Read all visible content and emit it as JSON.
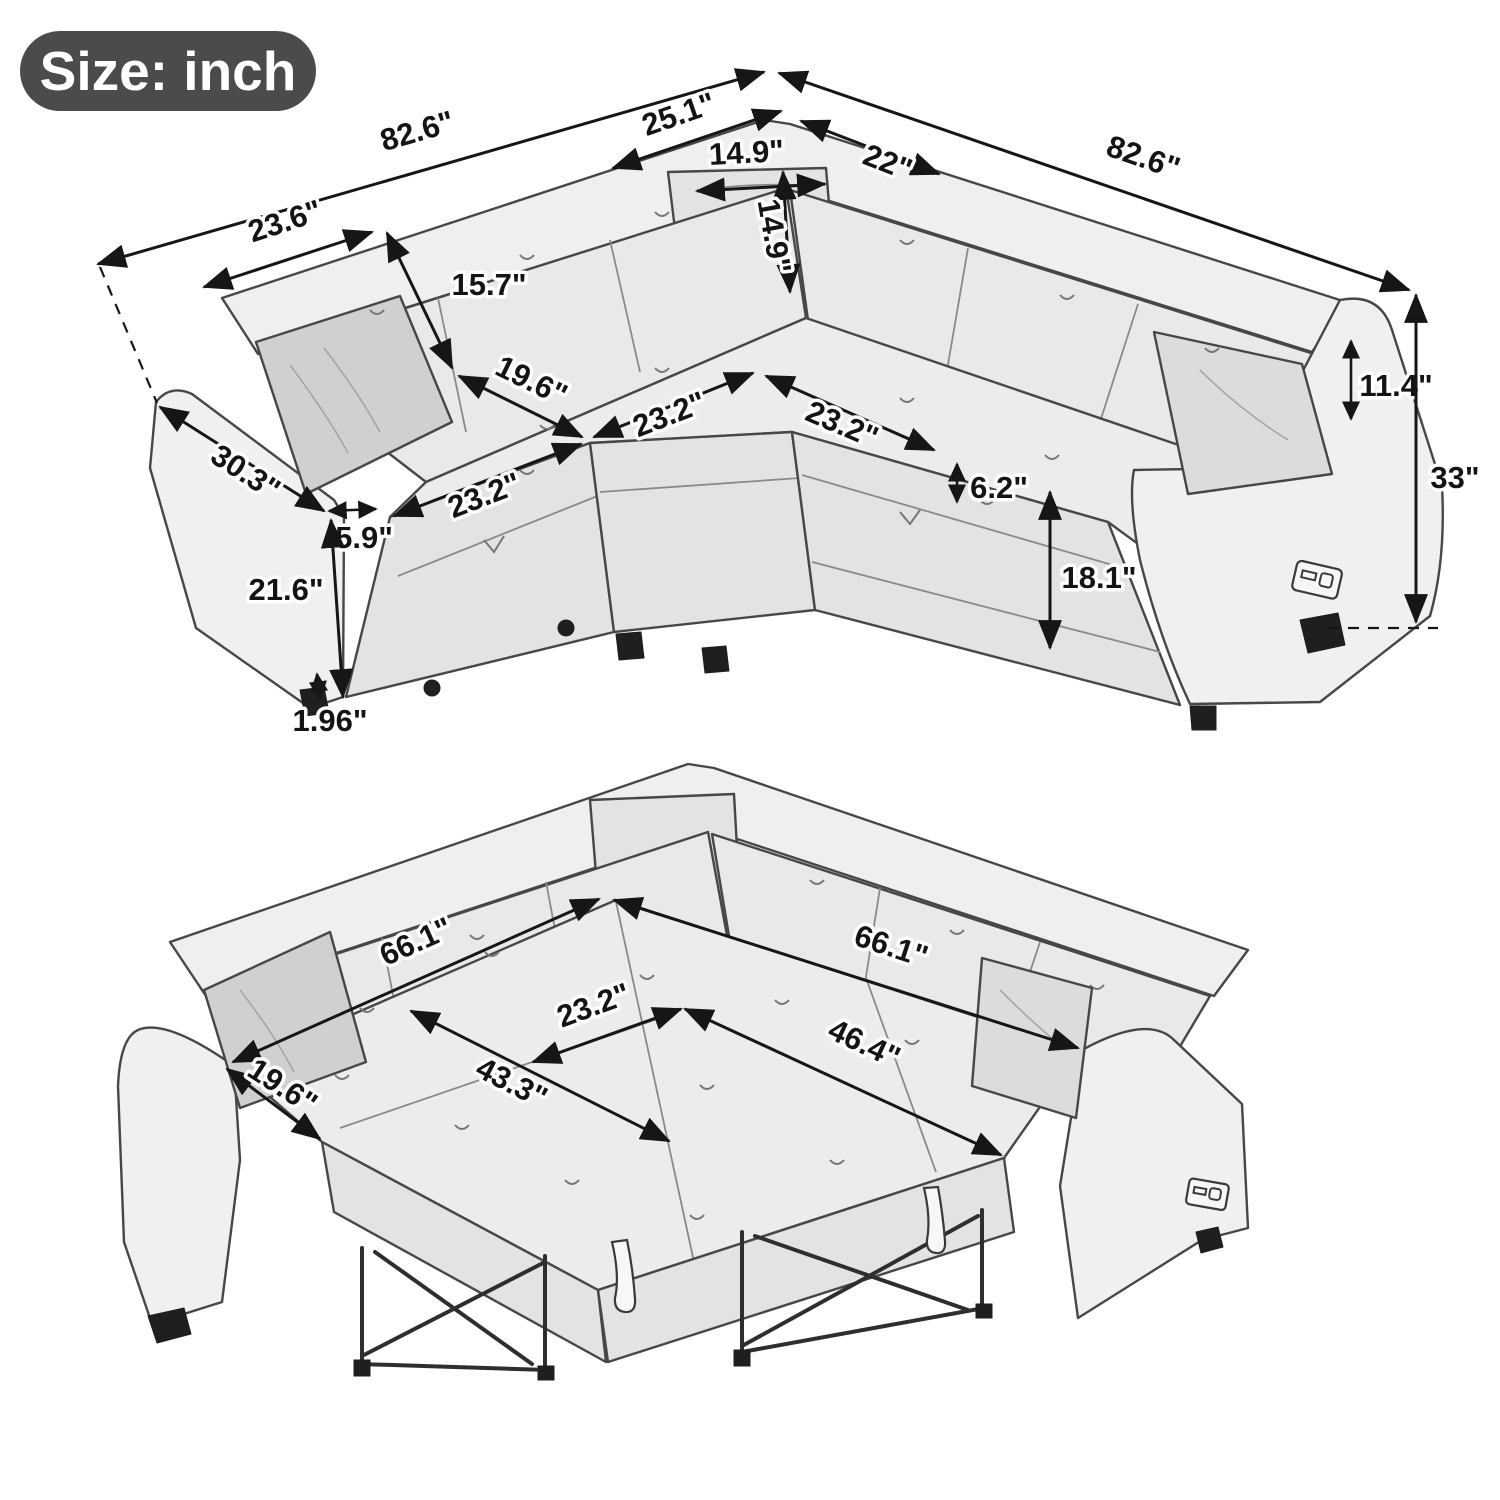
{
  "badge": {
    "label": "Size: inch"
  },
  "sofa_view": {
    "name": "sectional sofa - seating configuration",
    "dims": {
      "overall_left": "82.6\"",
      "corner_left": "25.1\"",
      "corner_right": "22\"",
      "overall_right": "82.6\"",
      "pillow_w": "14.9\"",
      "pillow_h": "14.9\"",
      "back_cushion_w": "23.6\"",
      "back_cushion_h": "15.7\"",
      "seat_depth": "19.6\"",
      "seat_w_left": "23.2\"",
      "seat_w_center_left": "23.2\"",
      "seat_w_center_right": "23.2\"",
      "cushion_thickness": "6.2\"",
      "seat_height": "18.1\"",
      "arm_depth": "30.3\"",
      "arm_width": "5.9\"",
      "arm_height": "21.6\"",
      "clearance": "1.96\"",
      "back_above_arm": "11.4\"",
      "overall_height": "33\""
    }
  },
  "bed_view": {
    "name": "sectional sofa - pull-out bed configuration",
    "dims": {
      "length_left": "66.1\"",
      "length_right": "66.1\"",
      "section_width": "23.2\"",
      "seat_depth": "19.6\"",
      "ottoman_length": "43.3\"",
      "pullout_width": "46.4\""
    }
  }
}
